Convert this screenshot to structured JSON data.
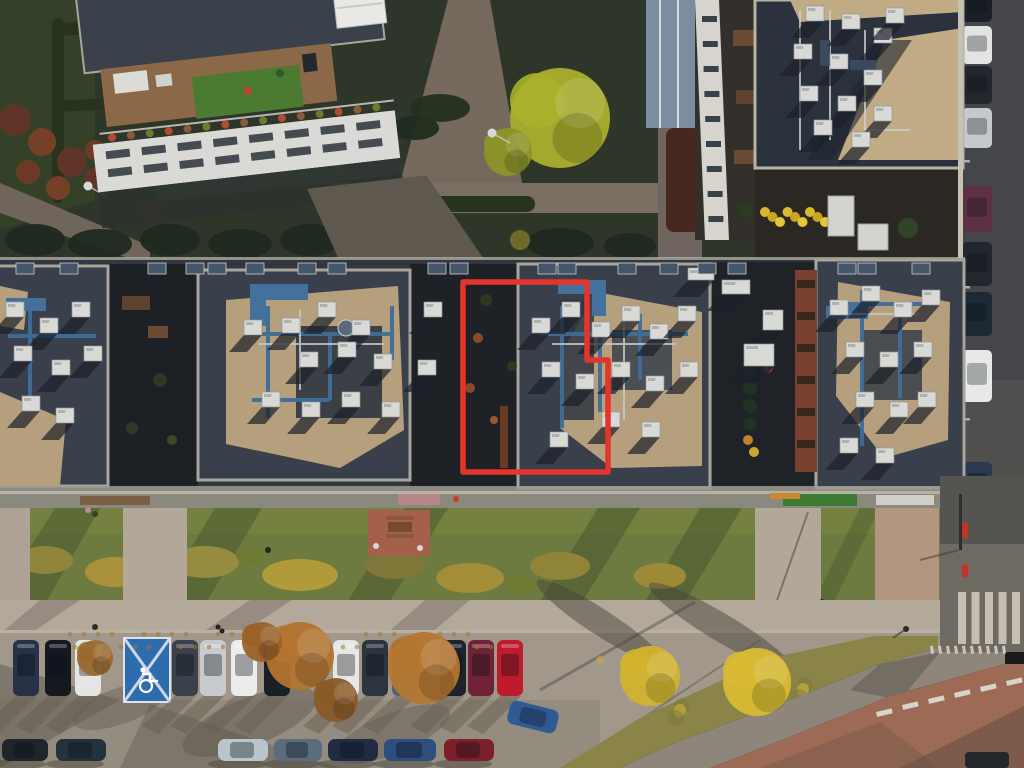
{
  "scene": {
    "type": "aerial-drone-photo",
    "description": "Top-down golden-hour aerial photo of a residential complex: a long row of flat gravel roofs with blue HVAC pipework, courtyard gardens above, lawn strip and parking lot below, road with crosswalk at right. One roof unit is outlined in red.",
    "annotation": "red property boundary outline"
  },
  "colors": {
    "highlight_red": "#e5352b",
    "roof_dark": "#31363f",
    "roof_block": "#39404c",
    "gravel_light": "#b59f7d",
    "pipe_blue": "#3e6d98",
    "hvac_white": "#d9dad6",
    "terrace_dark": "#1e2227",
    "courtyard_green": "#2e3529",
    "lawn_green": "#6d7a40",
    "sidewalk": "#b3a99b",
    "parking_pavement": "#a1988b",
    "road_dark": "#454649",
    "plaza_red": "#9c6a55",
    "disabled_blue": "#2e6cb0",
    "crosswalk_white": "#ccc6ba"
  },
  "highlight": {
    "points": "463,282 587,282 587,360 608,360 608,472 463,472",
    "color": "#e5352b",
    "width": 5.5
  },
  "row_skylights": [
    16,
    60,
    148,
    186,
    208,
    246,
    298,
    328,
    428,
    450,
    538,
    558,
    618,
    660,
    698,
    728,
    838,
    858,
    912
  ],
  "hvac": {
    "blockA": [
      [
        6,
        302
      ],
      [
        40,
        318
      ],
      [
        72,
        302
      ],
      [
        14,
        346
      ],
      [
        52,
        360
      ],
      [
        84,
        346
      ],
      [
        22,
        396
      ],
      [
        56,
        408
      ]
    ],
    "blockB": [
      [
        282,
        318
      ],
      [
        318,
        302
      ],
      [
        352,
        320
      ],
      [
        300,
        352
      ],
      [
        338,
        342
      ],
      [
        374,
        354
      ],
      [
        262,
        392
      ],
      [
        302,
        402
      ],
      [
        342,
        392
      ],
      [
        382,
        402
      ],
      [
        418,
        360
      ],
      [
        424,
        302
      ],
      [
        244,
        320
      ]
    ],
    "blockC": [
      [
        532,
        318
      ],
      [
        562,
        302
      ],
      [
        592,
        322
      ],
      [
        622,
        306
      ],
      [
        650,
        324
      ],
      [
        678,
        306
      ],
      [
        542,
        362
      ],
      [
        576,
        374
      ],
      [
        612,
        362
      ],
      [
        646,
        376
      ],
      [
        680,
        362
      ],
      [
        602,
        412
      ],
      [
        642,
        422
      ],
      [
        550,
        432
      ]
    ],
    "blockD": [
      [
        830,
        300
      ],
      [
        862,
        286
      ],
      [
        894,
        302
      ],
      [
        922,
        290
      ],
      [
        846,
        342
      ],
      [
        880,
        352
      ],
      [
        914,
        342
      ],
      [
        856,
        392
      ],
      [
        890,
        402
      ],
      [
        918,
        392
      ],
      [
        840,
        438
      ],
      [
        876,
        448
      ]
    ],
    "topRight": [
      [
        806,
        6
      ],
      [
        842,
        14
      ],
      [
        874,
        28
      ],
      [
        794,
        44
      ],
      [
        830,
        54
      ],
      [
        864,
        70
      ],
      [
        800,
        86
      ],
      [
        838,
        96
      ],
      [
        874,
        106
      ],
      [
        814,
        120
      ],
      [
        852,
        132
      ],
      [
        886,
        8
      ]
    ],
    "terrace": [
      [
        763,
        310,
        20,
        20
      ],
      [
        744,
        344,
        30,
        22
      ],
      [
        722,
        280,
        28,
        14
      ],
      [
        688,
        268,
        26,
        12
      ]
    ]
  },
  "cars": {
    "top_row": [
      {
        "x": 13,
        "c": "#273249"
      },
      {
        "x": 45,
        "c": "#15191f"
      },
      {
        "x": 75,
        "c": "#e4e5e4"
      },
      {
        "x": 172,
        "c": "#3a414b"
      },
      {
        "x": 200,
        "c": "#c8cbcd"
      },
      {
        "x": 231,
        "c": "#ebecec"
      },
      {
        "x": 264,
        "c": "#1b2026"
      },
      {
        "x": 333,
        "c": "#e6e7e6"
      },
      {
        "x": 362,
        "c": "#2c343e"
      },
      {
        "x": 392,
        "c": "#51627a"
      },
      {
        "x": 440,
        "c": "#1d222b"
      },
      {
        "x": 468,
        "c": "#702337"
      },
      {
        "x": 497,
        "c": "#bf1b2c"
      }
    ],
    "bottom_row": [
      {
        "x": 2,
        "c": "#20242b",
        "w": 46
      },
      {
        "x": 56,
        "c": "#23333d",
        "w": 50
      },
      {
        "x": 218,
        "c": "#b9c4cb",
        "w": 50
      },
      {
        "x": 274,
        "c": "#5a6c7e",
        "w": 48
      },
      {
        "x": 328,
        "c": "#1f2c44",
        "w": 50
      },
      {
        "x": 384,
        "c": "#2e4e7e",
        "w": 52
      },
      {
        "x": 444,
        "c": "#7e1f2c",
        "w": 50
      }
    ],
    "angled": {
      "x": 508,
      "y": 705,
      "w": 50,
      "h": 24,
      "c": "#2f5a94",
      "rot": 14
    },
    "right_road": [
      {
        "y": -8,
        "h": 30,
        "c": "#1b2026"
      },
      {
        "y": 26,
        "h": 38,
        "c": "#e2e3e2"
      },
      {
        "y": 66,
        "h": 38,
        "c": "#23272d"
      },
      {
        "y": 108,
        "h": 40,
        "c": "#c6c9cb"
      },
      {
        "y": 186,
        "h": 46,
        "c": "#5d3044"
      },
      {
        "y": 242,
        "h": 44,
        "c": "#22262d"
      },
      {
        "y": 292,
        "h": 44,
        "c": "#1e2936"
      },
      {
        "y": 350,
        "h": 52,
        "c": "#e7e8e7"
      },
      {
        "y": 462,
        "h": 44,
        "c": "#2a3850"
      }
    ]
  },
  "disabled_bay": {
    "x": 124,
    "y": 638,
    "w": 46,
    "h": 64,
    "color": "#2e6cb0"
  },
  "trees": {
    "courtyard": [
      {
        "x": 560,
        "y": 118,
        "r": 50,
        "c": "#a9b02c"
      },
      {
        "x": 508,
        "y": 152,
        "r": 24,
        "c": "#8c9428"
      }
    ],
    "parking": [
      {
        "x": 300,
        "y": 656,
        "r": 34,
        "c": "#b2742f"
      },
      {
        "x": 262,
        "y": 642,
        "r": 20,
        "c": "#9a6128"
      },
      {
        "x": 424,
        "y": 668,
        "r": 36,
        "c": "#b5772f"
      },
      {
        "x": 95,
        "y": 658,
        "r": 18,
        "c": "#9a6930"
      },
      {
        "x": 336,
        "y": 700,
        "r": 22,
        "c": "#8a5a28"
      }
    ],
    "bottom_right": [
      {
        "x": 650,
        "y": 676,
        "r": 30,
        "c": "#d2b32f"
      },
      {
        "x": 757,
        "y": 682,
        "r": 34,
        "c": "#d8bb33"
      }
    ]
  },
  "lawn_paths": [
    {
      "x": 0,
      "w": 30,
      "c": "#ada294"
    },
    {
      "x": 123,
      "w": 64,
      "c": "#b2a798"
    },
    {
      "x": 755,
      "w": 66,
      "c": "#b2a798"
    },
    {
      "x": 875,
      "w": 64,
      "c": "#b2967f"
    }
  ],
  "right_road_dashes": [
    120,
    160,
    200,
    244,
    286,
    330,
    374,
    418
  ],
  "plaza_dashes": [
    [
      876,
      712
    ],
    [
      902,
      705
    ],
    [
      928,
      699
    ],
    [
      954,
      693
    ],
    [
      980,
      687
    ],
    [
      1006,
      681
    ]
  ],
  "lamps": [
    [
      88,
      186
    ],
    [
      338,
      168
    ],
    [
      492,
      133
    ],
    [
      735,
      175
    ]
  ]
}
